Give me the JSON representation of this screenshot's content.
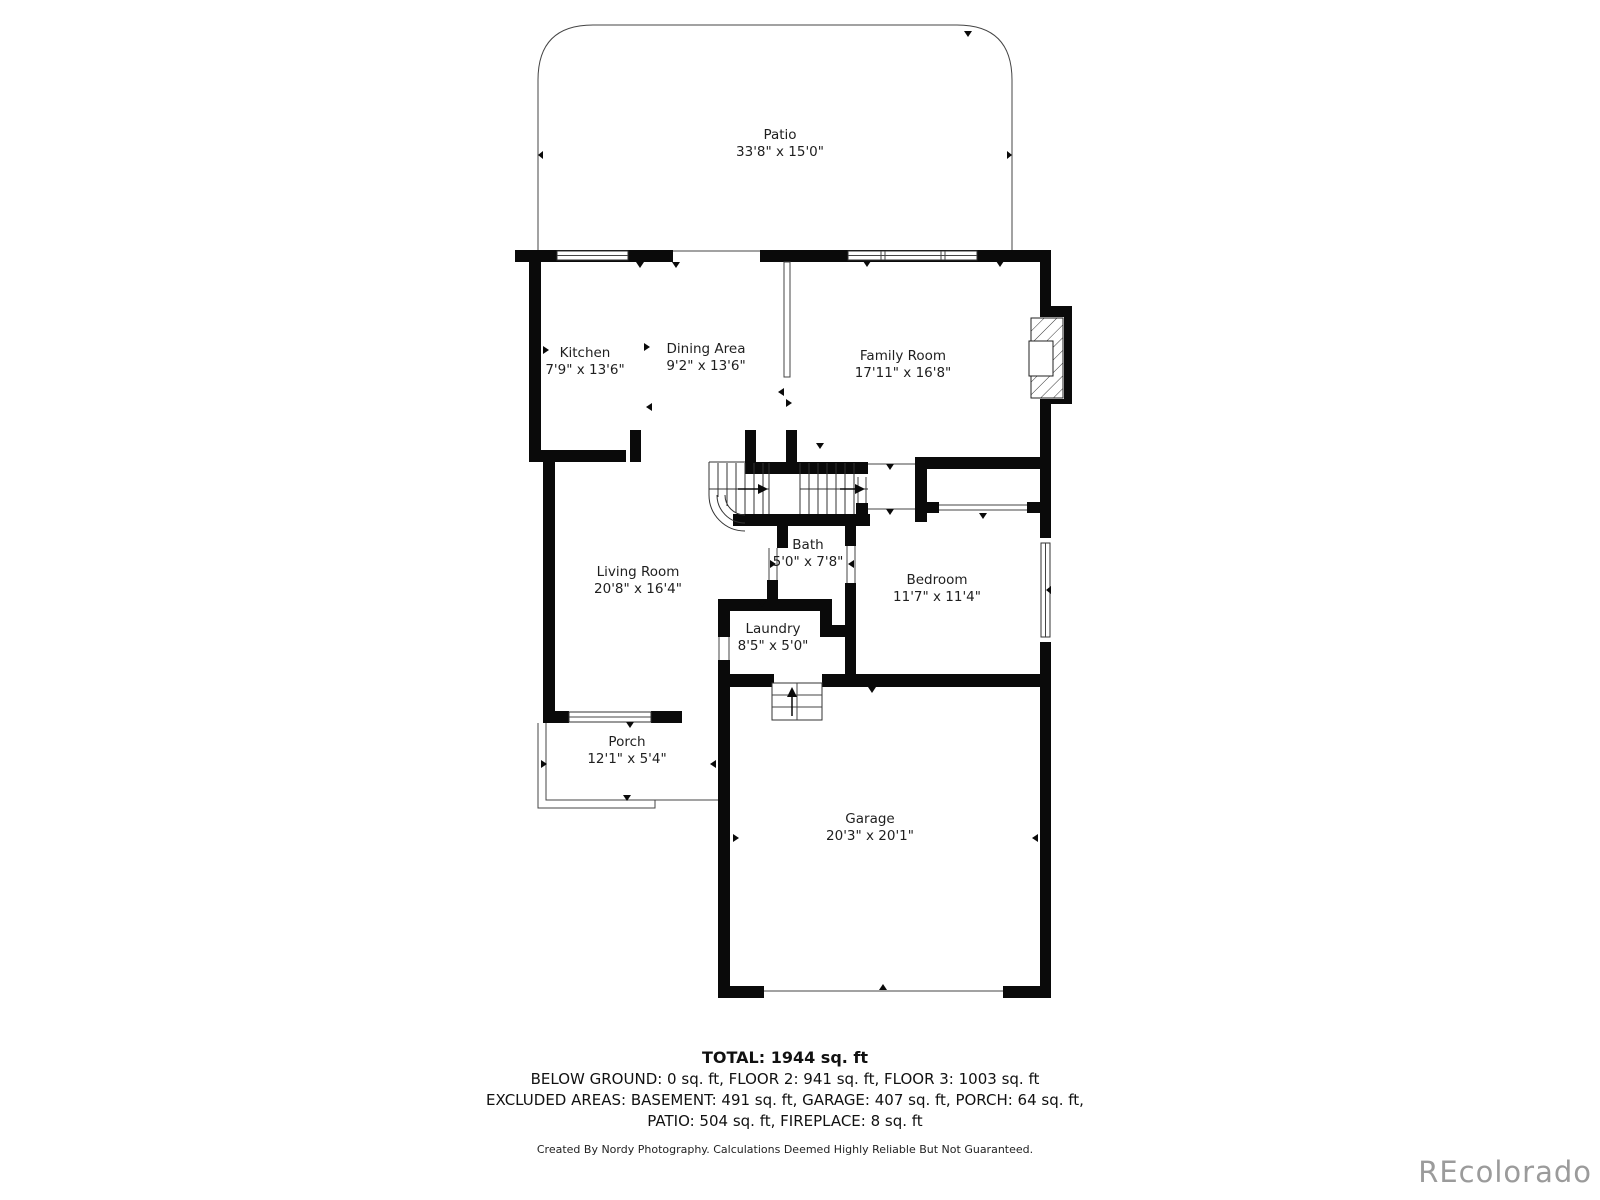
{
  "rooms": {
    "patio": {
      "name": "Patio",
      "dims": "33'8\" x 15'0\""
    },
    "kitchen": {
      "name": "Kitchen",
      "dims": "7'9\" x 13'6\""
    },
    "dining": {
      "name": "Dining Area",
      "dims": "9'2\" x 13'6\""
    },
    "family": {
      "name": "Family Room",
      "dims": "17'11\" x 16'8\""
    },
    "living": {
      "name": "Living Room",
      "dims": "20'8\" x 16'4\""
    },
    "bath": {
      "name": "Bath",
      "dims": "5'0\" x 7'8\""
    },
    "bedroom": {
      "name": "Bedroom",
      "dims": "11'7\" x 11'4\""
    },
    "laundry": {
      "name": "Laundry",
      "dims": "8'5\" x 5'0\""
    },
    "porch": {
      "name": "Porch",
      "dims": "12'1\" x 5'4\""
    },
    "garage": {
      "name": "Garage",
      "dims": "20'3\" x 20'1\""
    }
  },
  "summary": {
    "total": "TOTAL: 1944 sq. ft",
    "floors_line": "BELOW GROUND: 0 sq. ft, FLOOR 2: 941 sq. ft, FLOOR 3: 1003 sq. ft",
    "excluded_line1": "EXCLUDED AREAS: BASEMENT: 491 sq. ft, GARAGE: 407 sq. ft, PORCH: 64 sq. ft,",
    "excluded_line2": "PATIO: 504 sq. ft, FIREPLACE: 8 sq. ft"
  },
  "credit": "Created By Nordy Photography. Calculations Deemed Highly Reliable But Not Guaranteed.",
  "watermark": "REcolorado",
  "colors": {
    "wall": "#0a0a0a",
    "thin_line": "#555555",
    "text": "#1f1f1f",
    "watermark": "#9b9b9b"
  }
}
